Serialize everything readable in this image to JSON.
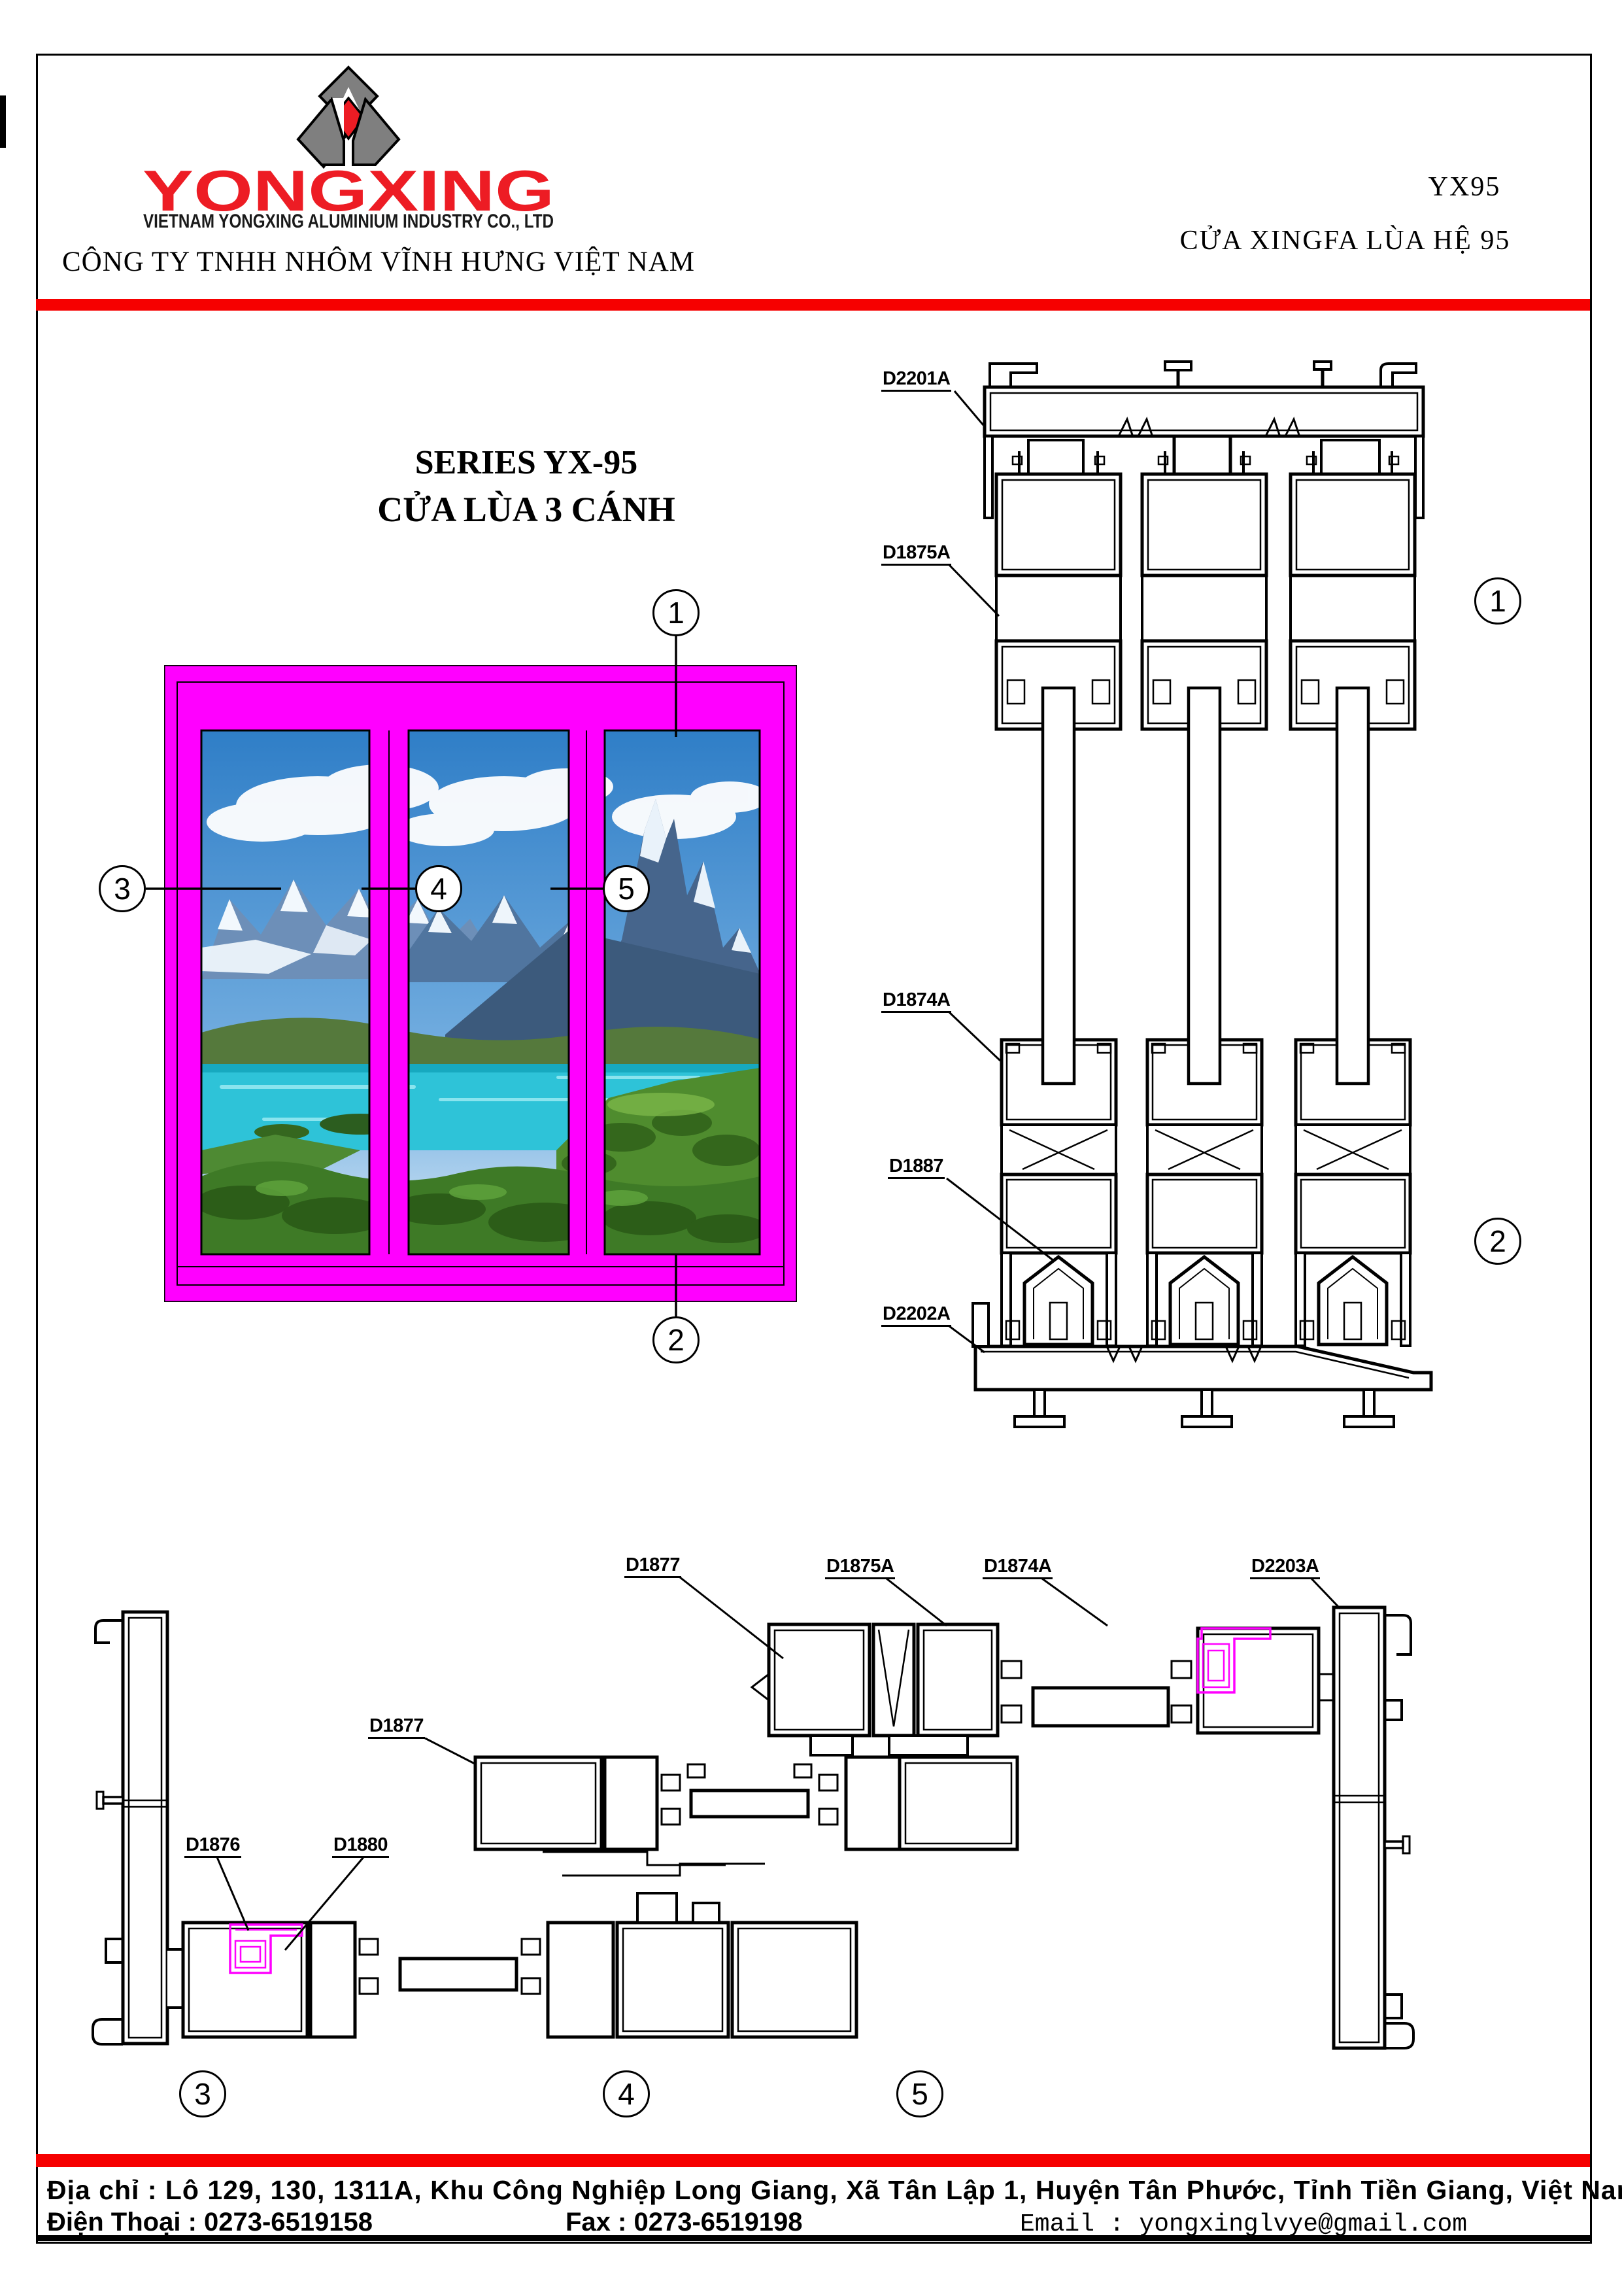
{
  "header": {
    "brand": "YONGXING",
    "brand_subtitle": "VIETNAM YONGXING ALUMINIUM INDUSTRY CO., LTD",
    "company_line": "CÔNG TY TNHH NHÔM VĨNH HƯNG VIỆT NAM",
    "model_code": "YX95",
    "model_name": "CỬA XINGFA LÙA HỆ 95"
  },
  "title": {
    "line1": "SERIES YX-95",
    "line2": "CỬA LÙA 3 CÁNH"
  },
  "profile_labels": {
    "d2201a": "D2201A",
    "d1875a": "D1875A",
    "d1874a": "D1874A",
    "d1887": "D1887",
    "d2202a": "D2202A",
    "d2203a": "D2203A",
    "d1877": "D1877",
    "d1876": "D1876",
    "d1880": "D1880"
  },
  "callouts": {
    "n1": "1",
    "n2": "2",
    "n3": "3",
    "n4": "4",
    "n5": "5"
  },
  "footer": {
    "address": "Địa chỉ : Lô 129, 130, 1311A, Khu Công Nghiệp Long Giang, Xã Tân Lập 1, Huyện Tân Phước, Tỉnh Tiền Giang, Việt Nam",
    "phone": "Điện Thoại : 0273-6519158",
    "fax": "Fax : 0273-6519198",
    "email": "Email : yongxinglvye@gmail.com"
  },
  "colors": {
    "accent_red": "#ec1c24",
    "bar_red": "#f60000",
    "frame_magenta": "#ff00ff"
  }
}
